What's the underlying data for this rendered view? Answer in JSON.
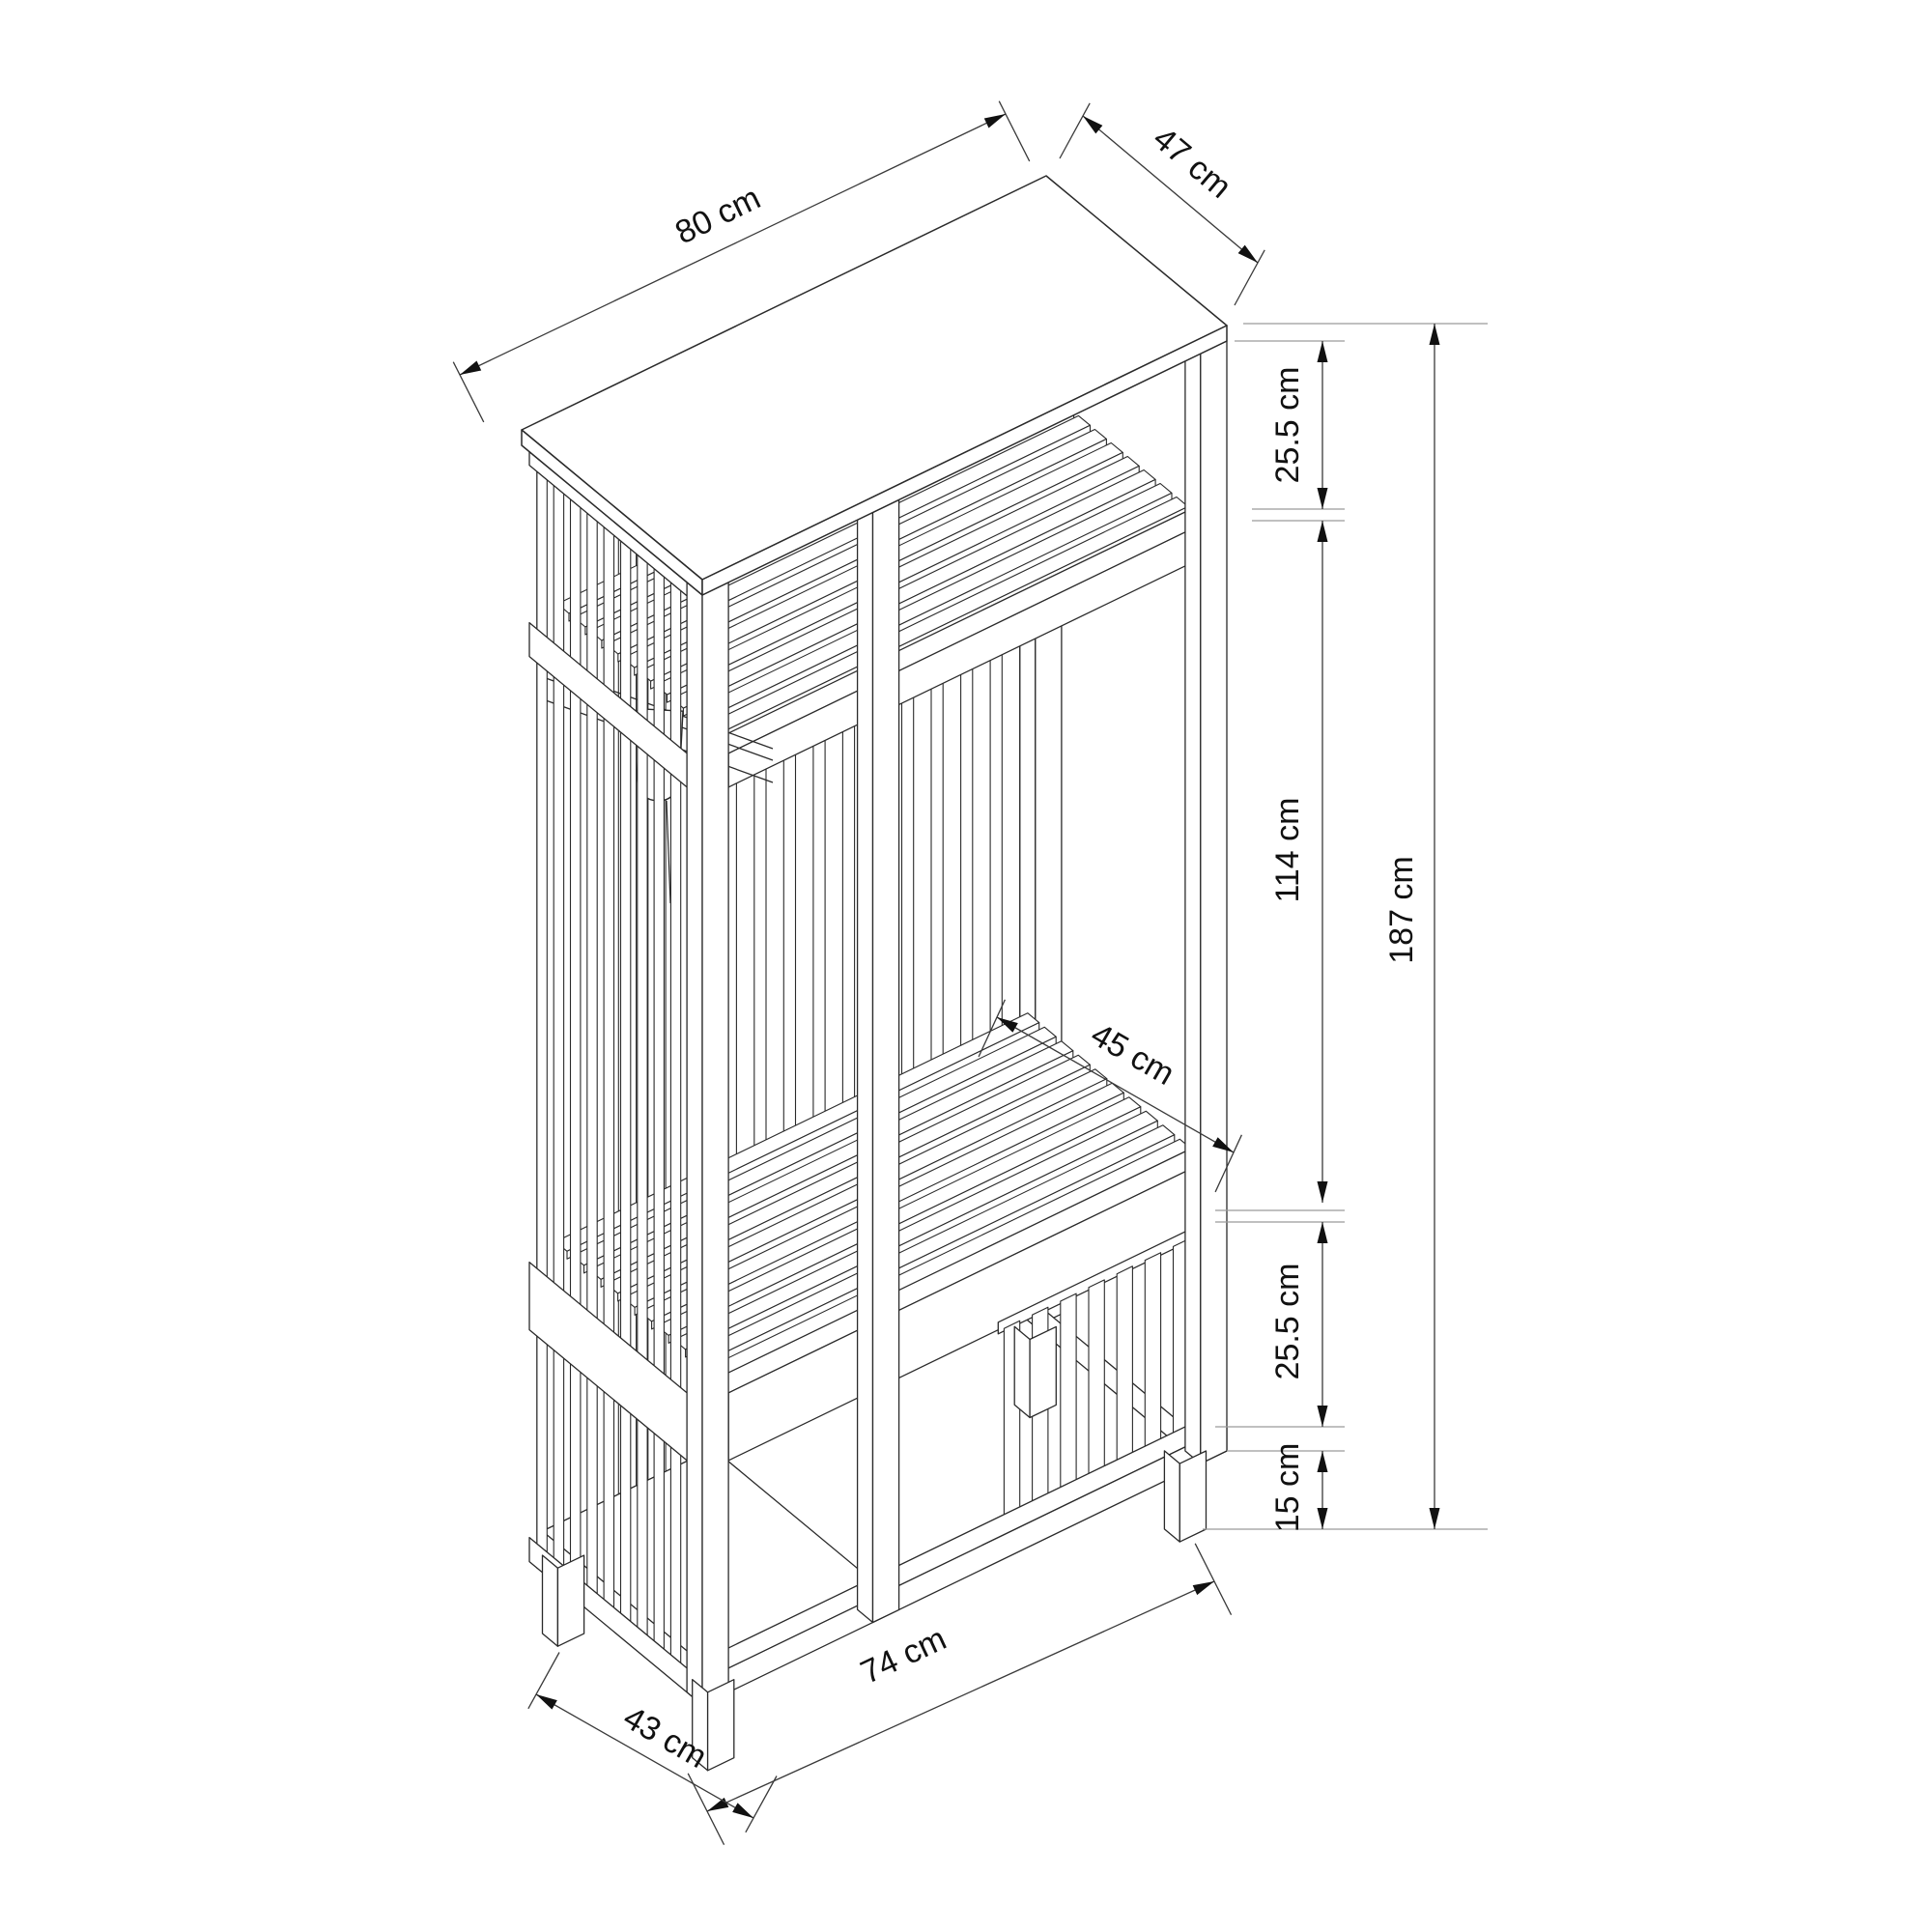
{
  "diagram": {
    "kind": "isometric furniture dimension drawing",
    "subject": "slatted open wardrobe with hat shelf, coat hook, bench and legs",
    "background_color": "#ffffff",
    "object_line_color": "#2a2a2a",
    "dimension_line_color": "#3a3a3a",
    "extension_line_color": "#9b9b9b",
    "units": "cm",
    "dimensions": {
      "top_width": {
        "value": 80,
        "label": "80 cm"
      },
      "top_depth": {
        "value": 47,
        "label": "47 cm"
      },
      "upper_section_height": {
        "value": 25.5,
        "label": "25.5 cm"
      },
      "middle_section_height": {
        "value": 114,
        "label": "114 cm"
      },
      "total_height": {
        "value": 187,
        "label": "187 cm"
      },
      "bench_depth": {
        "value": 45,
        "label": "45 cm"
      },
      "lower_section_height": {
        "value": 25.5,
        "label": "25.5 cm"
      },
      "leg_height": {
        "value": 15,
        "label": "15 cm"
      },
      "bottom_width": {
        "value": 74,
        "label": "74 cm"
      },
      "bottom_depth": {
        "value": 43,
        "label": "43 cm"
      }
    }
  }
}
